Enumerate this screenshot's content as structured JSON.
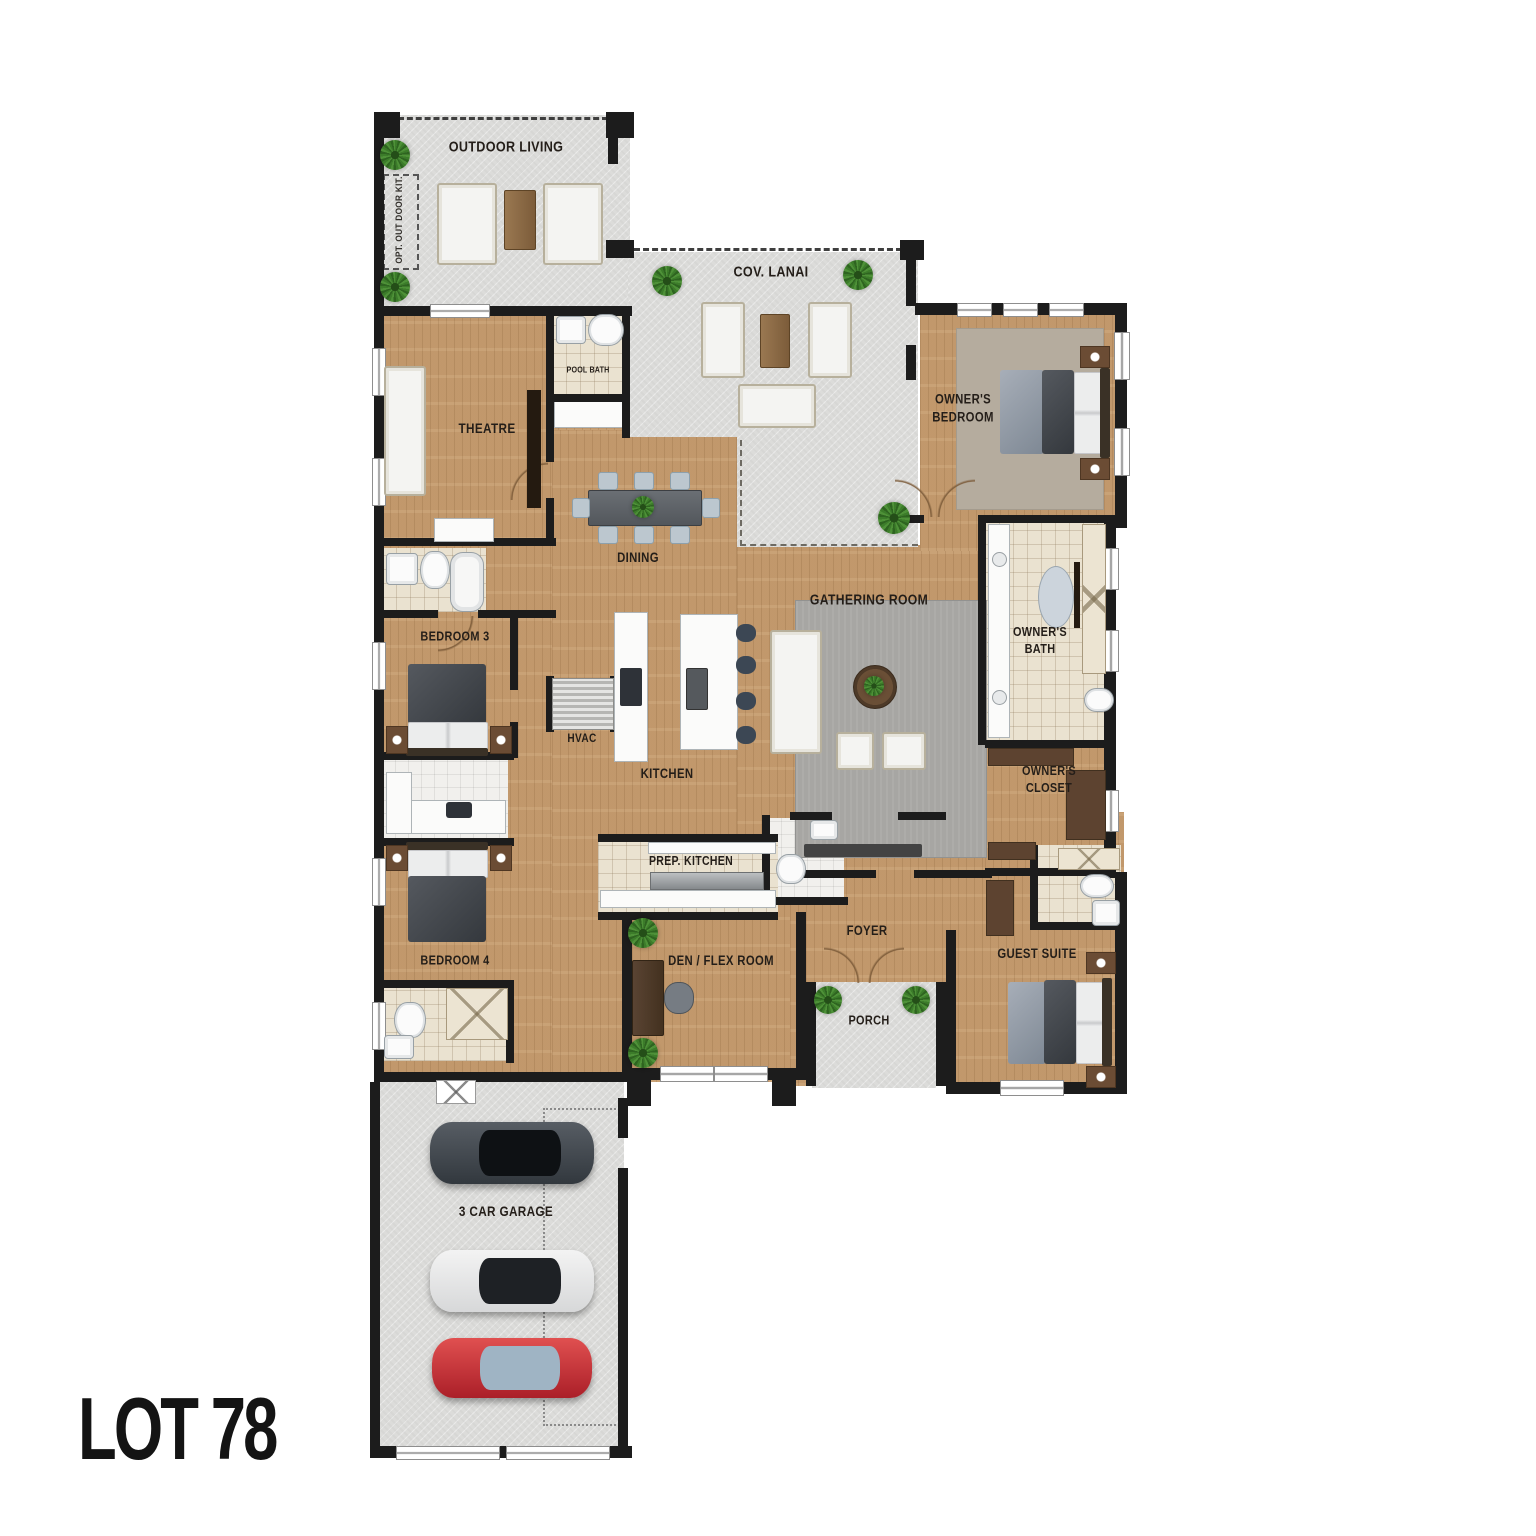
{
  "lot_label": "LOT 78",
  "plan": {
    "rooms": [
      {
        "id": "outdoor-living",
        "label": "OUTDOOR LIVING"
      },
      {
        "id": "opt-outdoor-kit",
        "label": "OPT. OUT DOOR KIT."
      },
      {
        "id": "cov-lanai",
        "label": "COV. LANAI"
      },
      {
        "id": "pool-bath",
        "label": "POOL BATH"
      },
      {
        "id": "theatre",
        "label": "THEATRE"
      },
      {
        "id": "owners-bedroom",
        "label": "OWNER'S\nBEDROOM"
      },
      {
        "id": "dining",
        "label": "DINING"
      },
      {
        "id": "gathering-room",
        "label": "GATHERING ROOM"
      },
      {
        "id": "owners-bath",
        "label": "OWNER'S\nBATH"
      },
      {
        "id": "bedroom-3",
        "label": "BEDROOM 3"
      },
      {
        "id": "hvac",
        "label": "HVAC"
      },
      {
        "id": "kitchen",
        "label": "KITCHEN"
      },
      {
        "id": "owners-closet",
        "label": "OWNER'S\nCLOSET"
      },
      {
        "id": "prep-kitchen",
        "label": "PREP. KITCHEN"
      },
      {
        "id": "bedroom-4",
        "label": "BEDROOM 4"
      },
      {
        "id": "foyer",
        "label": "FOYER"
      },
      {
        "id": "den-flex",
        "label": "DEN / FLEX ROOM"
      },
      {
        "id": "porch",
        "label": "PORCH"
      },
      {
        "id": "guest-suite",
        "label": "GUEST SUITE"
      },
      {
        "id": "garage",
        "label": "3 CAR GARAGE"
      }
    ],
    "colors": {
      "wood_floor": "#c69c6e",
      "concrete": "#dcdcda",
      "wall": "#1c1c1c",
      "tile_beige": "#eae2d0",
      "tile_white": "#f1f0ed",
      "rug_gray": "#a7a6a3",
      "rug_taupe": "#b5ac9e",
      "furniture_wood": "#8a6642",
      "plant_green": "#3c7c2a",
      "car_red": "#c03038",
      "car_white": "#e9e9e9",
      "car_dark": "#454b52",
      "label_text": "#241e19"
    },
    "icons": {
      "plant-icon": "top-view palm plant (green starburst circle)",
      "sofa-icon": "white rectangle with cushion inset",
      "bed-icon": "comforter + pillows + headboard",
      "toilet-icon": "rounded white oval",
      "sink-icon": "white square basin",
      "tub-icon": "rounded white oblong",
      "shower-icon": "tiled square with X",
      "car-icon": "top-view car body with windshield",
      "door-arc-icon": "quarter-circle swing arc"
    }
  }
}
